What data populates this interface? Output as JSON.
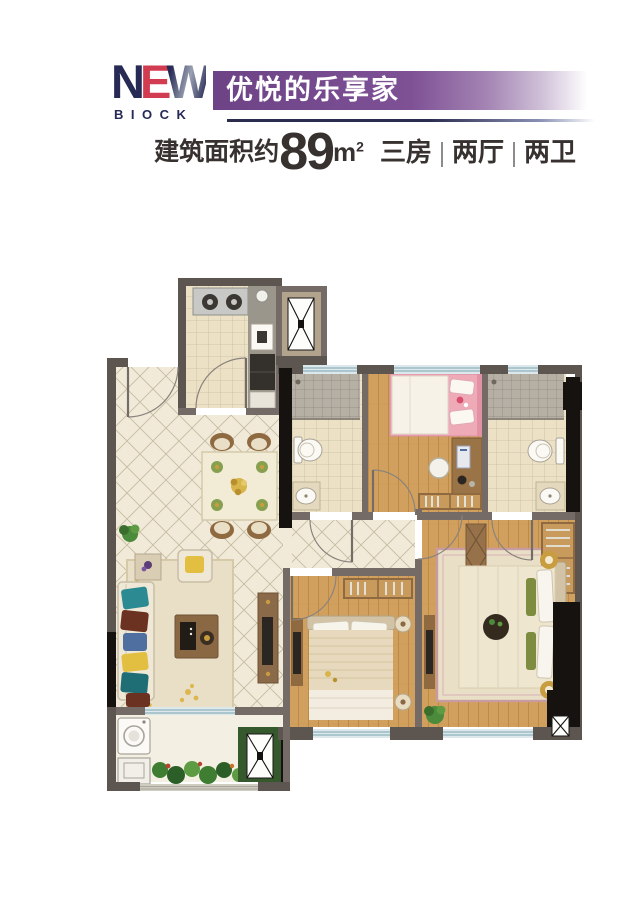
{
  "header": {
    "logo": {
      "n": "N",
      "e": "E",
      "w": "W",
      "sub": "BIOCK"
    },
    "banner_title": "优悦的乐享家",
    "area": {
      "prefix": "建筑面积约",
      "value": "89",
      "unit": "m",
      "unit_sup": "2"
    },
    "spec_items": [
      "三房",
      "两厅",
      "两卫"
    ]
  },
  "palette": {
    "wall": "#5d5550",
    "partition": "#746b66",
    "black": "#15120f",
    "floor-tile": "#f1ead9",
    "tile-line": "#c6bba2",
    "bath-tile": "#ece1c5",
    "shower-tile": "#b5afa4",
    "shower-line": "#8e8880",
    "wood": "#d2a05e",
    "wood-line": "#bb8b47",
    "balcony-floor": "#f4efe3",
    "window": "#dce8eb",
    "window-line": "#8fb2bb",
    "banner-purple": "#7b4f92",
    "logo-navy": "#262a55",
    "logo-red": "#d23c50",
    "text-dark": "#37322f",
    "separator-gray": "#8c8c8c",
    "furniture-brown": "#96714a",
    "wardrobe-inner": "#c89a5c",
    "sofa-cream": "#efe8d7",
    "rug-beige": "#e9dfc7",
    "bed-cream": "#efe6cf",
    "headboard-tan": "#d2c3a6",
    "pink": "#efaab8",
    "teal": "#2b8a92",
    "maroon": "#6b3222",
    "yellow": "#e2bf40",
    "gold": "#c79d3f",
    "green": "#4c8a3c",
    "dark-green": "#35592c",
    "taupe": "#b2a38c",
    "white-fixture": "#fbf9f4",
    "fixture-line": "#a9a296",
    "counter-gray": "#9a968b",
    "appliance-dark": "#34312c"
  },
  "floor_plan": {
    "rooms": [
      "entry",
      "kitchen",
      "utility-shaft",
      "dining-area",
      "guest-bathroom",
      "kids-bedroom",
      "master-bathroom",
      "hallway",
      "second-bedroom",
      "master-bedroom",
      "living-room",
      "balcony",
      "laundry-shaft"
    ]
  }
}
